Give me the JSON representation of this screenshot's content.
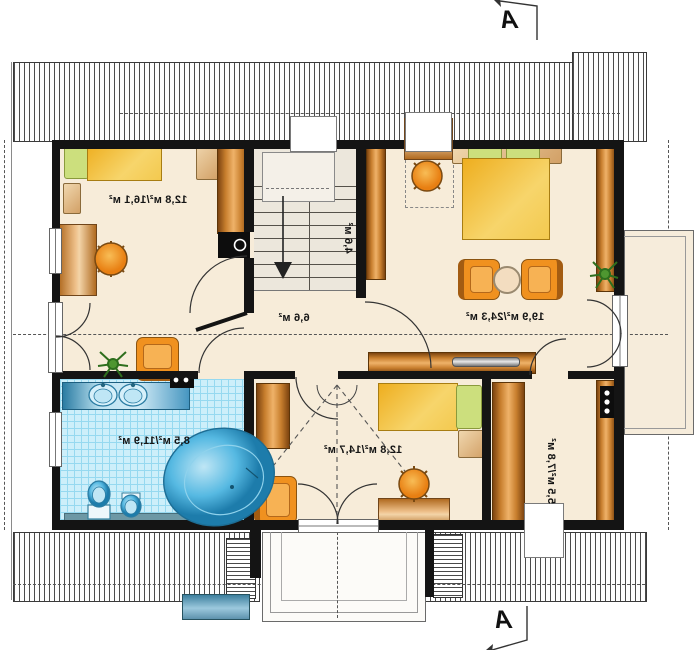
{
  "plan": {
    "type": "floor-plan-upper-storey",
    "mirrored_text": true,
    "rooms": [
      {
        "name": "bedroom-top-left",
        "area_label": "12,8 м²/16,1 м²"
      },
      {
        "name": "staircase",
        "area_label": "4,6 м²"
      },
      {
        "name": "bedroom-large",
        "area_label": "19,9 м²/24,3 м²"
      },
      {
        "name": "hallway",
        "area_label": "6,6 м²"
      },
      {
        "name": "bathroom",
        "area_label": "8,5 м²/11,9 м²"
      },
      {
        "name": "bedroom-bottom",
        "area_label": "12,8 м²/14,7 м²"
      },
      {
        "name": "wardrobe-room",
        "area_label": "5,5 м²/7,8 м²"
      }
    ],
    "section_markers": {
      "top": "A",
      "bottom": "A"
    },
    "colors": {
      "wall": "#141414",
      "floor": "#f7ecd9",
      "stair_floor": "#ece7dc",
      "tile": "#cdeffa",
      "tile_line": "#96d9f0",
      "wood_dark": "#7d4410",
      "wood_light": "#efb269",
      "bed_yellow": "#f3c94f",
      "pillow_green": "#ccdf7d",
      "chair_orange": "#f0911f",
      "water_blue": "#56b9e2",
      "roof_hatch": "#4a4a4a"
    }
  }
}
